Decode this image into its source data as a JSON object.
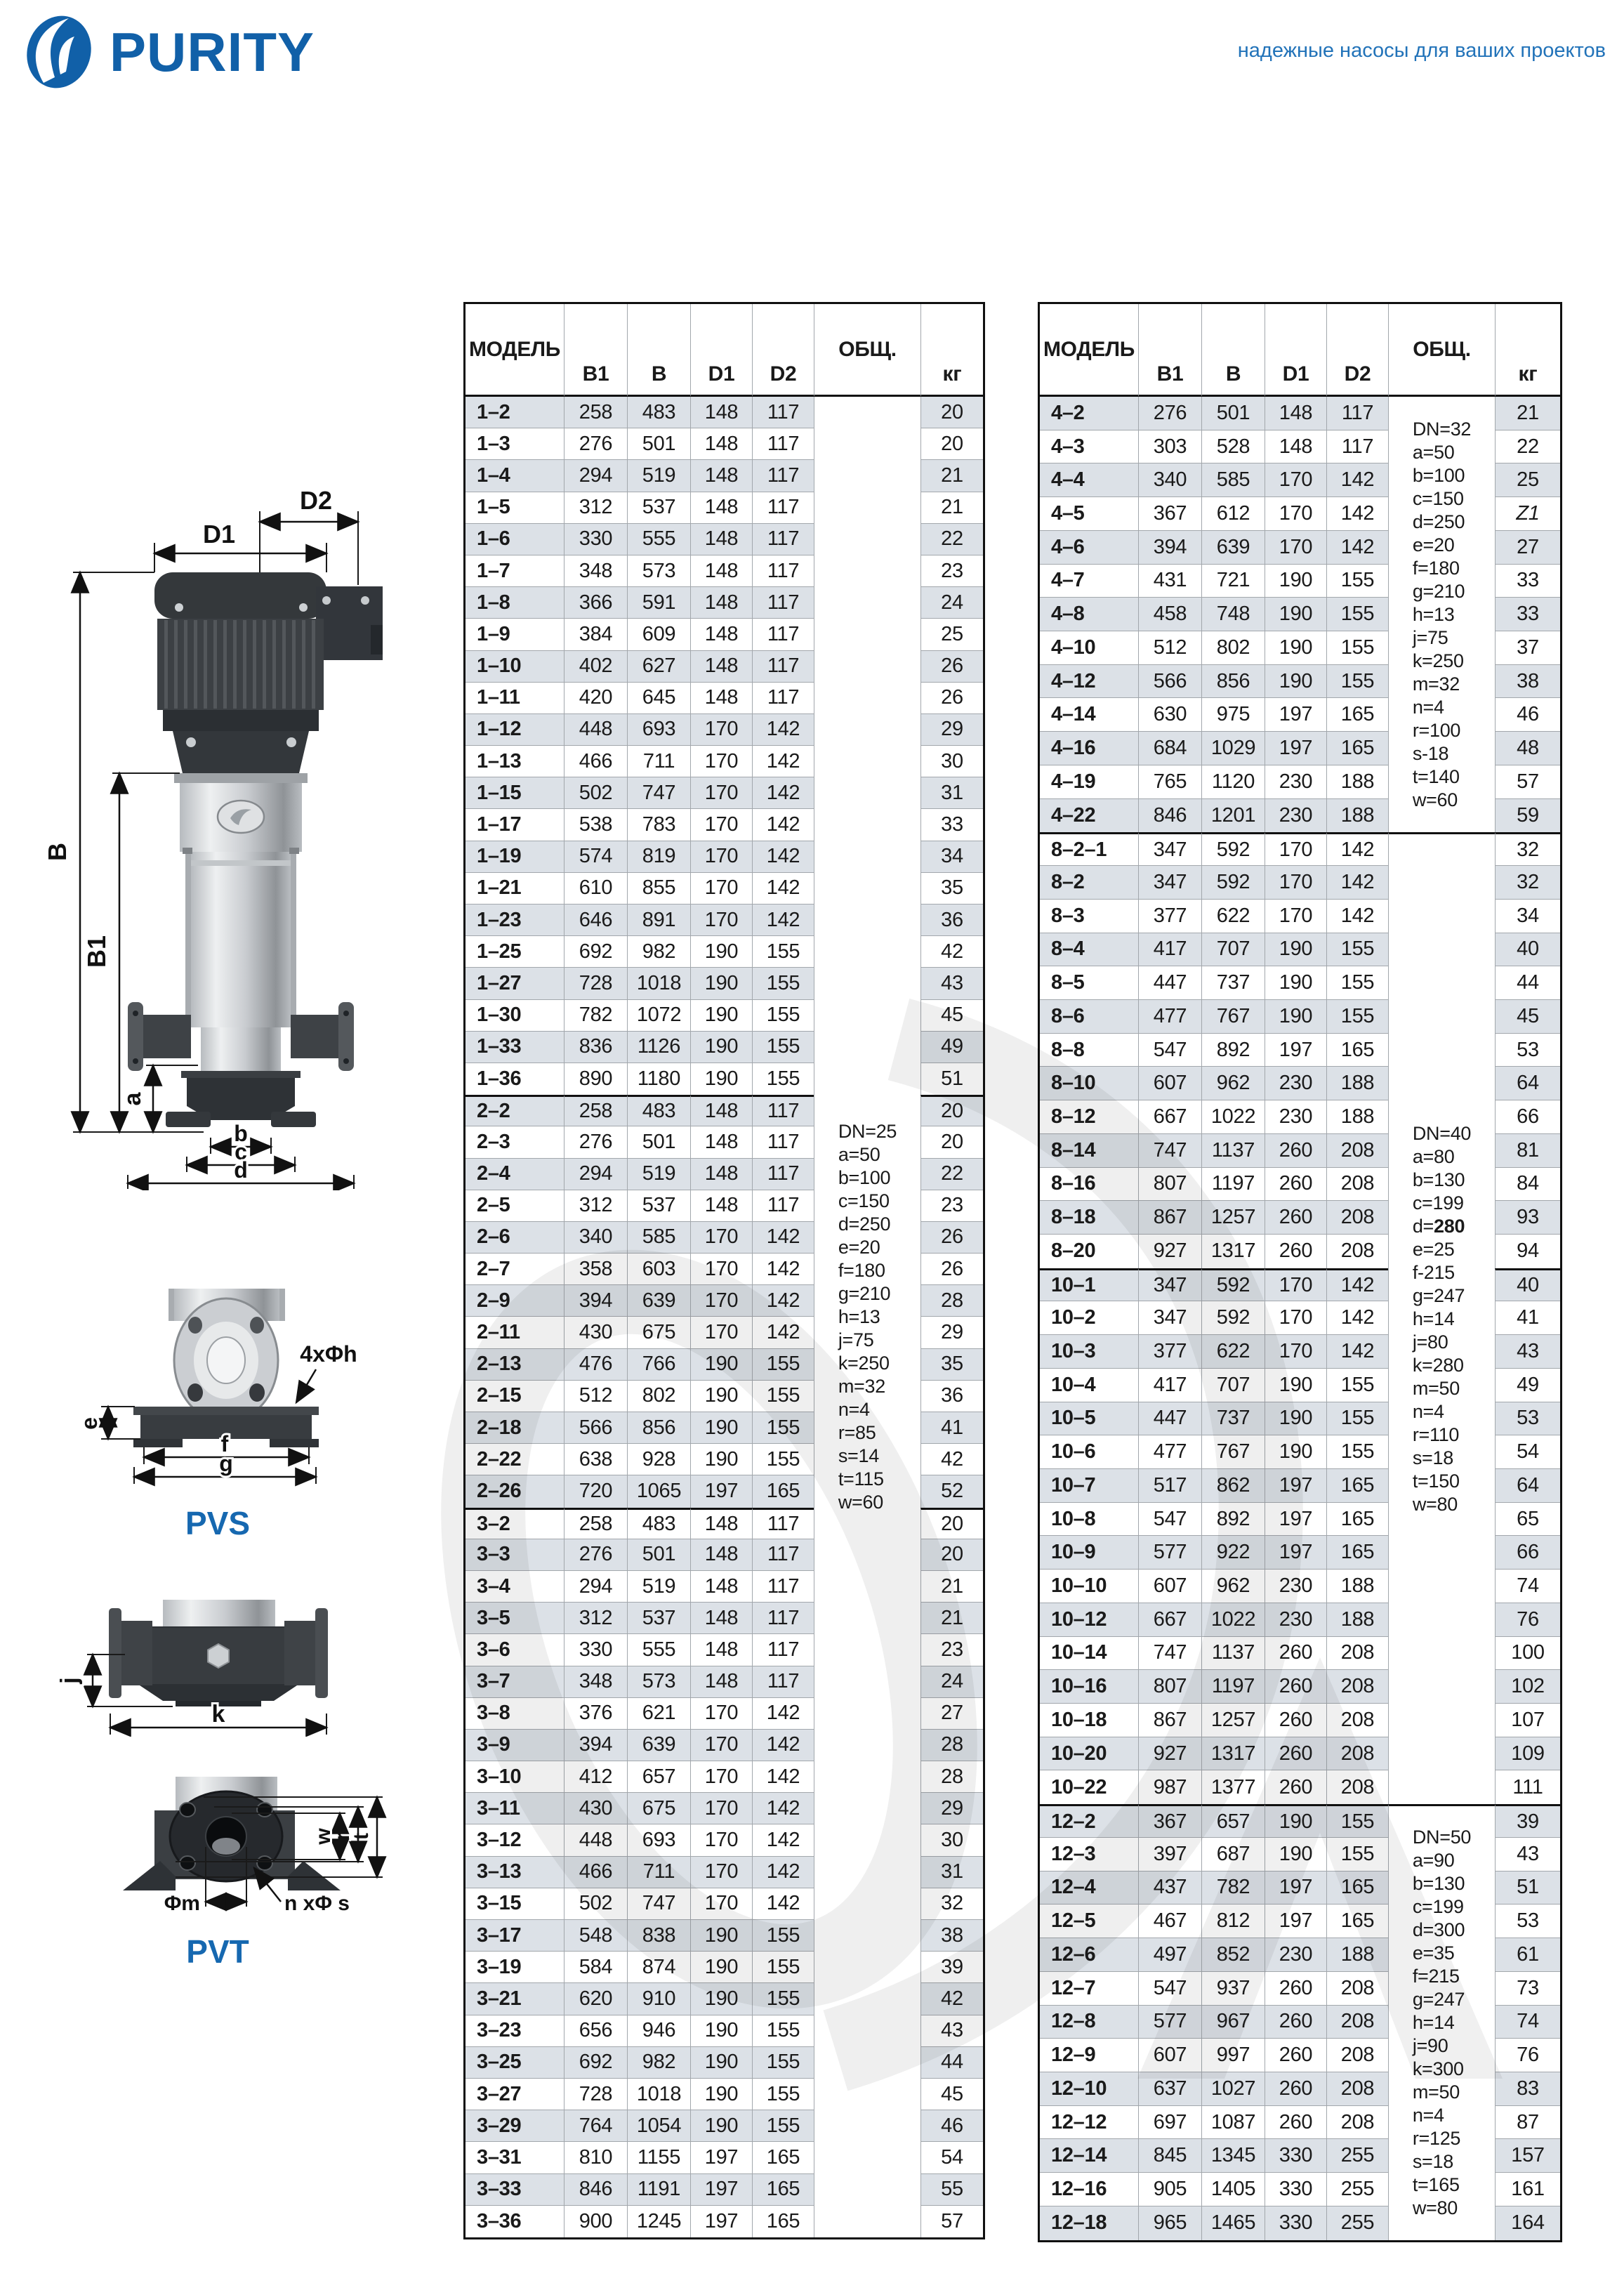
{
  "page": {
    "brand": "PURITY",
    "tagline": "надежные насосы для ваших проектов",
    "accent_color": "#1160a8",
    "stripe_color": "#dce1e7"
  },
  "diagrams": {
    "pvs_label": "PVS",
    "pvt_label": "PVT",
    "main": {
      "d2": "D2",
      "d1": "D1",
      "b": "B",
      "b1": "B1",
      "a": "a",
      "b_dim": "b",
      "c": "c",
      "d": "d"
    },
    "pvs_view": {
      "e": "e",
      "f": "f",
      "g": "g",
      "holes": "4xΦh"
    },
    "pvt_side": {
      "j": "j",
      "k": "k"
    },
    "pvt_face": {
      "w": "w",
      "r": "r",
      "t": "t",
      "m": "Φm",
      "holes": "n xΦ s"
    }
  },
  "tables": {
    "columns": [
      "МОДЕЛЬ",
      "B1",
      "B",
      "D1",
      "D2",
      "ОБЩ.",
      "кг"
    ],
    "left": {
      "groups": [
        {
          "rows": [
            [
              "1–2",
              258,
              483,
              148,
              117,
              20
            ],
            [
              "1–3",
              276,
              501,
              148,
              117,
              20
            ],
            [
              "1–4",
              294,
              519,
              148,
              117,
              21
            ],
            [
              "1–5",
              312,
              537,
              148,
              117,
              21
            ],
            [
              "1–6",
              330,
              555,
              148,
              117,
              22
            ],
            [
              "1–7",
              348,
              573,
              148,
              117,
              23
            ],
            [
              "1–8",
              366,
              591,
              148,
              117,
              24
            ],
            [
              "1–9",
              384,
              609,
              148,
              117,
              25
            ],
            [
              "1–10",
              402,
              627,
              148,
              117,
              26
            ],
            [
              "1–11",
              420,
              645,
              148,
              117,
              26
            ],
            [
              "1–12",
              448,
              693,
              170,
              142,
              29
            ],
            [
              "1–13",
              466,
              711,
              170,
              142,
              30
            ],
            [
              "1–15",
              502,
              747,
              170,
              142,
              31
            ],
            [
              "1–17",
              538,
              783,
              170,
              142,
              33
            ],
            [
              "1–19",
              574,
              819,
              170,
              142,
              34
            ],
            [
              "1–21",
              610,
              855,
              170,
              142,
              35
            ],
            [
              "1–23",
              646,
              891,
              170,
              142,
              36
            ],
            [
              "1–25",
              692,
              982,
              190,
              155,
              42
            ],
            [
              "1–27",
              728,
              1018,
              190,
              155,
              43
            ],
            [
              "1–30",
              782,
              1072,
              190,
              155,
              45
            ],
            [
              "1–33",
              836,
              1126,
              190,
              155,
              49
            ],
            [
              "1–36",
              890,
              1180,
              190,
              155,
              51
            ]
          ]
        },
        {
          "rows": [
            [
              "2–2",
              258,
              483,
              148,
              117,
              20
            ],
            [
              "2–3",
              276,
              501,
              148,
              117,
              20
            ],
            [
              "2–4",
              294,
              519,
              148,
              117,
              22
            ],
            [
              "2–5",
              312,
              537,
              148,
              117,
              23
            ],
            [
              "2–6",
              340,
              585,
              170,
              142,
              26
            ],
            [
              "2–7",
              358,
              603,
              170,
              142,
              26
            ],
            [
              "2–9",
              394,
              639,
              170,
              142,
              28
            ],
            [
              "2–11",
              430,
              675,
              170,
              142,
              29
            ],
            [
              "2–13",
              476,
              766,
              190,
              155,
              35
            ],
            [
              "2–15",
              512,
              802,
              190,
              155,
              36
            ],
            [
              "2–18",
              566,
              856,
              190,
              155,
              41
            ],
            [
              "2–22",
              638,
              928,
              190,
              155,
              42
            ],
            [
              "2–26",
              720,
              1065,
              197,
              165,
              52
            ]
          ]
        },
        {
          "rows": [
            [
              "3–2",
              258,
              483,
              148,
              117,
              20
            ],
            [
              "3–3",
              276,
              501,
              148,
              117,
              20
            ],
            [
              "3–4",
              294,
              519,
              148,
              117,
              21
            ],
            [
              "3–5",
              312,
              537,
              148,
              117,
              21
            ],
            [
              "3–6",
              330,
              555,
              148,
              117,
              23
            ],
            [
              "3–7",
              348,
              573,
              148,
              117,
              24
            ],
            [
              "3–8",
              376,
              621,
              170,
              142,
              27
            ],
            [
              "3–9",
              394,
              639,
              170,
              142,
              28
            ],
            [
              "3–10",
              412,
              657,
              170,
              142,
              28
            ],
            [
              "3–11",
              430,
              675,
              170,
              142,
              29
            ],
            [
              "3–12",
              448,
              693,
              170,
              142,
              30
            ],
            [
              "3–13",
              466,
              711,
              170,
              142,
              31
            ],
            [
              "3–15",
              502,
              747,
              170,
              142,
              32
            ],
            [
              "3–17",
              548,
              838,
              190,
              155,
              38
            ],
            [
              "3–19",
              584,
              874,
              190,
              155,
              39
            ],
            [
              "3–21",
              620,
              910,
              190,
              155,
              42
            ],
            [
              "3–23",
              656,
              946,
              190,
              155,
              43
            ],
            [
              "3–25",
              692,
              982,
              190,
              155,
              44
            ],
            [
              "3–27",
              728,
              1018,
              190,
              155,
              45
            ],
            [
              "3–29",
              764,
              1054,
              190,
              155,
              46
            ],
            [
              "3–31",
              810,
              1155,
              197,
              165,
              54
            ],
            [
              "3–33",
              846,
              1191,
              197,
              165,
              55
            ],
            [
              "3–36",
              900,
              1245,
              197,
              165,
              57
            ]
          ]
        }
      ],
      "specs": [
        {
          "from": 0,
          "to": 2,
          "lines": [
            "DN=25",
            "a=50",
            "b=100",
            "c=150",
            "d=250",
            "e=20",
            "f=180",
            "g=210",
            "h=13",
            "j=75",
            "k=250",
            "m=32",
            "n=4",
            "r=85",
            "s=14",
            "t=115",
            "w=60"
          ]
        }
      ]
    },
    "right": {
      "groups": [
        {
          "rows": [
            [
              "4–2",
              276,
              501,
              148,
              117,
              "21"
            ],
            [
              "4–3",
              303,
              528,
              148,
              117,
              "22"
            ],
            [
              "4–4",
              340,
              585,
              170,
              142,
              "25"
            ],
            [
              "4–5",
              367,
              612,
              170,
              142,
              "Z1"
            ],
            [
              "4–6",
              394,
              639,
              170,
              142,
              "27"
            ],
            [
              "4–7",
              431,
              721,
              190,
              155,
              "33"
            ],
            [
              "4–8",
              458,
              748,
              190,
              155,
              "33"
            ],
            [
              "4–10",
              512,
              802,
              190,
              155,
              "37"
            ],
            [
              "4–12",
              566,
              856,
              190,
              155,
              "38"
            ],
            [
              "4–14",
              630,
              975,
              197,
              165,
              "46"
            ],
            [
              "4–16",
              684,
              1029,
              197,
              165,
              "48"
            ],
            [
              "4–19",
              765,
              1120,
              230,
              188,
              "57"
            ],
            [
              "4–22",
              846,
              1201,
              230,
              188,
              "59"
            ]
          ]
        },
        {
          "rows": [
            [
              "8–2–1",
              347,
              592,
              170,
              142,
              32
            ],
            [
              "8–2",
              347,
              592,
              170,
              142,
              32
            ],
            [
              "8–3",
              377,
              622,
              170,
              142,
              34
            ],
            [
              "8–4",
              417,
              707,
              190,
              155,
              40
            ],
            [
              "8–5",
              447,
              737,
              190,
              155,
              44
            ],
            [
              "8–6",
              477,
              767,
              190,
              155,
              45
            ],
            [
              "8–8",
              547,
              892,
              197,
              165,
              53
            ],
            [
              "8–10",
              607,
              962,
              230,
              188,
              64
            ],
            [
              "8–12",
              667,
              1022,
              230,
              188,
              66
            ],
            [
              "8–14",
              747,
              1137,
              260,
              208,
              81
            ],
            [
              "8–16",
              807,
              1197,
              260,
              208,
              84
            ],
            [
              "8–18",
              867,
              1257,
              260,
              208,
              93
            ],
            [
              "8–20",
              927,
              1317,
              260,
              208,
              94
            ]
          ]
        },
        {
          "rows": [
            [
              "10–1",
              347,
              592,
              170,
              142,
              40
            ],
            [
              "10–2",
              347,
              592,
              170,
              142,
              41
            ],
            [
              "10–3",
              377,
              622,
              170,
              142,
              43
            ],
            [
              "10–4",
              417,
              707,
              190,
              155,
              49
            ],
            [
              "10–5",
              447,
              737,
              190,
              155,
              53
            ],
            [
              "10–6",
              477,
              767,
              190,
              155,
              54
            ],
            [
              "10–7",
              517,
              862,
              197,
              165,
              64
            ],
            [
              "10–8",
              547,
              892,
              197,
              165,
              65
            ],
            [
              "10–9",
              577,
              922,
              197,
              165,
              66
            ],
            [
              "10–10",
              607,
              962,
              230,
              188,
              74
            ],
            [
              "10–12",
              667,
              1022,
              230,
              188,
              76
            ],
            [
              "10–14",
              747,
              1137,
              260,
              208,
              100
            ],
            [
              "10–16",
              807,
              1197,
              260,
              208,
              102
            ],
            [
              "10–18",
              867,
              1257,
              260,
              208,
              107
            ],
            [
              "10–20",
              927,
              1317,
              260,
              208,
              109
            ],
            [
              "10–22",
              987,
              1377,
              260,
              208,
              111
            ]
          ]
        },
        {
          "rows": [
            [
              "12–2",
              367,
              657,
              190,
              155,
              39
            ],
            [
              "12–3",
              397,
              687,
              190,
              155,
              43
            ],
            [
              "12–4",
              437,
              782,
              197,
              165,
              51
            ],
            [
              "12–5",
              467,
              812,
              197,
              165,
              53
            ],
            [
              "12–6",
              497,
              852,
              230,
              188,
              61
            ],
            [
              "12–7",
              547,
              937,
              260,
              208,
              73
            ],
            [
              "12–8",
              577,
              967,
              260,
              208,
              74
            ],
            [
              "12–9",
              607,
              997,
              260,
              208,
              76
            ],
            [
              "12–10",
              637,
              1027,
              260,
              208,
              83
            ],
            [
              "12–12",
              697,
              1087,
              260,
              208,
              87
            ],
            [
              "12–14",
              845,
              1345,
              330,
              255,
              157
            ],
            [
              "12–16",
              905,
              1405,
              330,
              255,
              161
            ],
            [
              "12–18",
              965,
              1465,
              330,
              255,
              164
            ]
          ]
        }
      ],
      "specs": [
        {
          "from": 0,
          "to": 0,
          "lines": [
            "DN=32",
            "a=50",
            "b=100",
            "c=150",
            "d=250",
            "e=20",
            "f=180",
            "g=210",
            "h=13",
            "j=75",
            "k=250",
            "m=32",
            "n=4",
            "r=100",
            "s-18",
            "t=140",
            "w=60"
          ]
        },
        {
          "from": 1,
          "to": 2,
          "lines": [
            "DN=40",
            "a=80",
            "b=130",
            "c=199",
            "d=280",
            "e=25",
            "f-215",
            "g=247",
            "h=14",
            "j=80",
            "k=280",
            "m=50",
            "n=4",
            "r=110",
            "s=18",
            "t=150",
            "w=80"
          ],
          "bold": [
            "d=280"
          ]
        },
        {
          "from": 3,
          "to": 3,
          "lines": [
            "DN=50",
            "a=90",
            "b=130",
            "c=199",
            "d=300",
            "e=35",
            "f=215",
            "g=247",
            "h=14",
            "j=90",
            "k=300",
            "m=50",
            "n=4",
            "r=125",
            "s=18",
            "t=165",
            "w=80"
          ]
        }
      ]
    }
  }
}
